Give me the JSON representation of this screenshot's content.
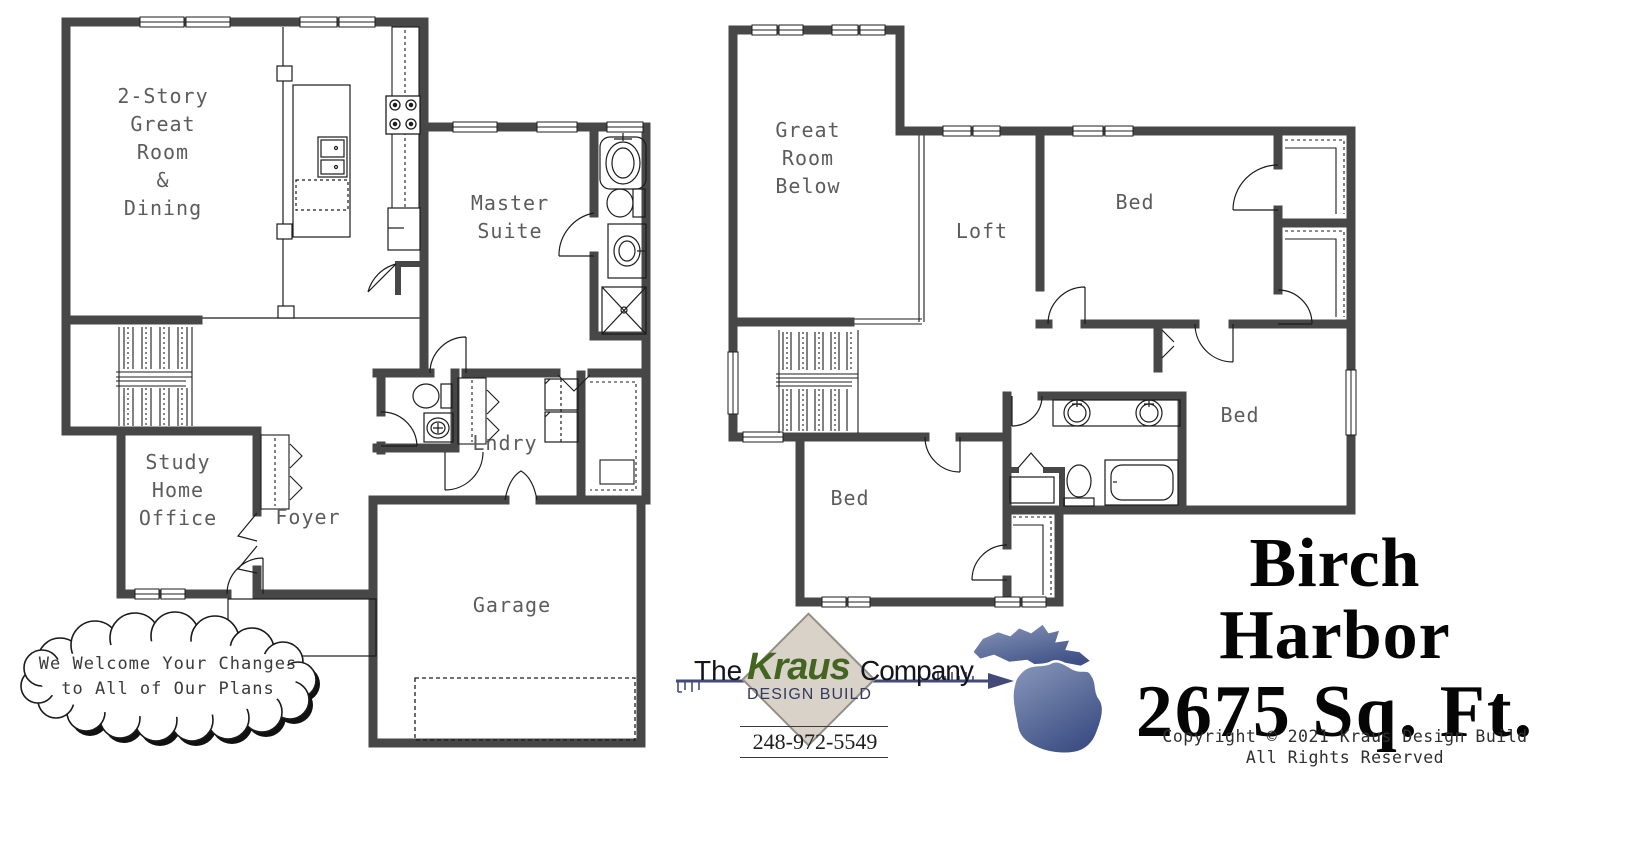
{
  "plans": {
    "first_floor": {
      "rooms": [
        {
          "id": "great-room",
          "label": "2-Story\nGreat\nRoom\n&\nDining"
        },
        {
          "id": "master-suite",
          "label": "Master\nSuite"
        },
        {
          "id": "study",
          "label": "Study\nHome\nOffice"
        },
        {
          "id": "foyer",
          "label": "Foyer"
        },
        {
          "id": "laundry",
          "label": "Lndry"
        },
        {
          "id": "garage",
          "label": "Garage"
        }
      ]
    },
    "second_floor": {
      "rooms": [
        {
          "id": "great-room-below",
          "label": "Great\nRoom\nBelow"
        },
        {
          "id": "loft",
          "label": "Loft"
        },
        {
          "id": "bed-1",
          "label": "Bed"
        },
        {
          "id": "bed-2",
          "label": "Bed"
        },
        {
          "id": "bed-3",
          "label": "Bed"
        }
      ]
    }
  },
  "callout": {
    "text": "We Welcome Your Changes\nto All of Our Plans"
  },
  "branding": {
    "prefix": "The",
    "name": "Kraus",
    "suffix": "Company",
    "tagline": "DESIGN BUILD",
    "phone": "248-972-5549"
  },
  "plan_title": {
    "name": "Birch Harbor",
    "area": "2675 Sq. Ft."
  },
  "copyright": {
    "line1": "Copyright © 2021 Kraus Design Build",
    "line2": "All Rights Reserved"
  },
  "colors": {
    "wall": "#474747",
    "thin_line": "#1c1c1c",
    "label_gray": "#5c5c5c",
    "kraus_green": "#44651f",
    "logo_navy": "#444a78",
    "diamond_tan": "#d8d2c9",
    "michigan_light": "#8191b5",
    "michigan_dark": "#46578c"
  }
}
